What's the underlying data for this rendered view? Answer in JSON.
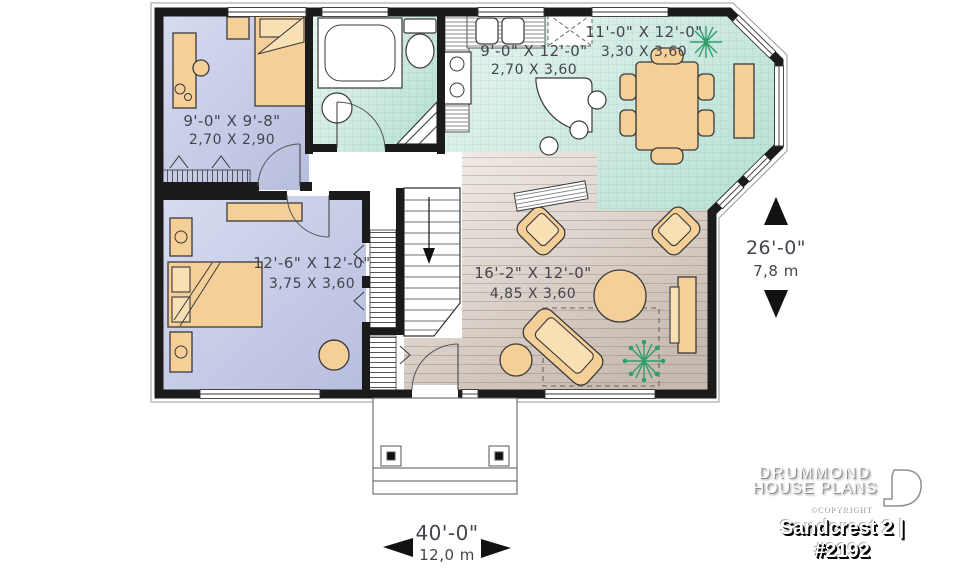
{
  "plan": {
    "rooms": {
      "bedroom_top": {
        "imperial": "9'-0\" X 9'-8\"",
        "metric": "2,70 X 2,90"
      },
      "kitchen": {
        "imperial": "9'-0\" X 12'-0\"",
        "metric": "2,70 X 3,60"
      },
      "dining": {
        "imperial": "11'-0\" X 12'-0\"",
        "metric": "3,30 X 3,60"
      },
      "bedroom_master": {
        "imperial": "12'-6\" X 12'-0\"",
        "metric": "3,75 X 3,60"
      },
      "living": {
        "imperial": "16'-2\" X 12'-0\"",
        "metric": "4,85 X 3,60"
      }
    },
    "overall": {
      "depth": {
        "imperial": "26'-0\"",
        "metric": "7,8 m"
      },
      "width": {
        "imperial": "40'-0\"",
        "metric": "12,0 m"
      }
    }
  },
  "branding": {
    "name_line1": "DRUMMOND",
    "name_line2": "HOUSE PLANS",
    "copyright": "©COPYRIGHT",
    "plan_title": "Sandcrest 2 | #2192"
  },
  "colors": {
    "wall": "#1b1b1b",
    "bedroom_floor": "#c7cbe8",
    "tile_floor": "#d6ede7",
    "wood_floor": "#d9cdc4",
    "furniture": "#f5cf98",
    "plant_green": "#2e9e6b",
    "dimension_text": "#44444e"
  }
}
